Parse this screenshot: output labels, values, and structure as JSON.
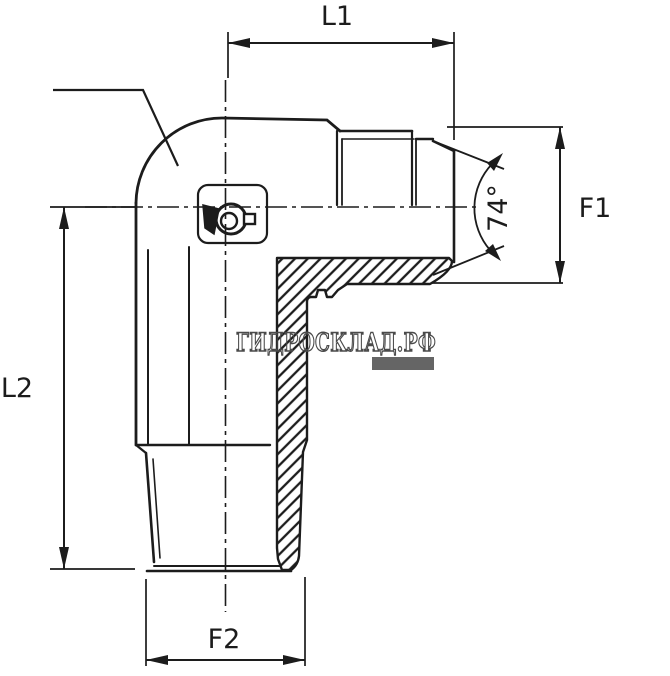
{
  "page": {
    "background": "#ffffff",
    "line_color": "#1c1c1c",
    "description": "Technical drawing of a 90-degree hydraulic elbow adapter fitting, half-sectioned, with JIC 74-degree flare male end (right) and tapered male thread end (bottom)"
  },
  "dimensions": {
    "l1": {
      "label": "L1"
    },
    "l2": {
      "label": "L2"
    },
    "f1": {
      "label": "F1"
    },
    "f2": {
      "label": "F2"
    },
    "flare_angle": {
      "label": "74°"
    }
  },
  "watermark": {
    "text": "ГИДРОСКЛАД.РФ",
    "color": "#4a4a4a"
  }
}
